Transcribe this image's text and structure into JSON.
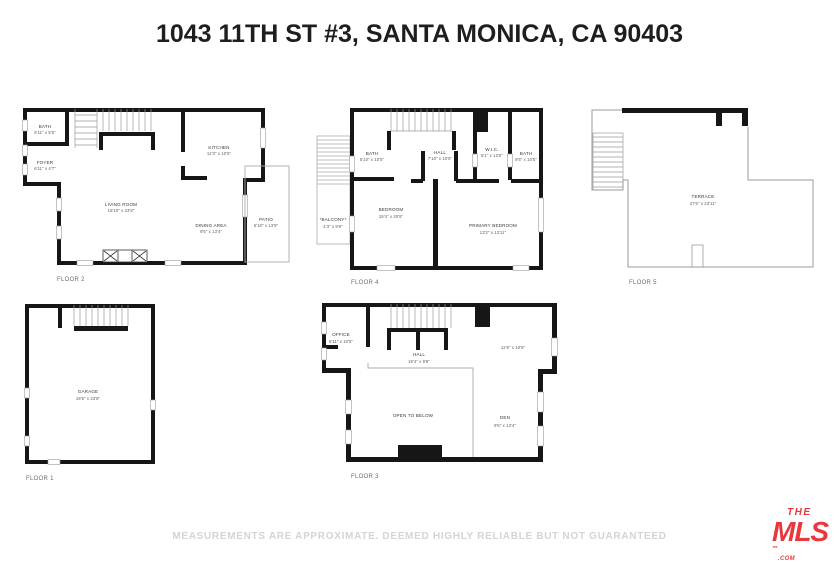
{
  "title": "1043 11TH ST #3, SANTA MONICA, CA 90403",
  "disclaimer": "MEASUREMENTS ARE APPROXIMATE. DEEMED HIGHLY RELIABLE BUT NOT GUARANTEED",
  "logo": {
    "the": "THE",
    "mls": "MLS",
    "tm": "™",
    "com": ".COM",
    "color": "#e8383d"
  },
  "colors": {
    "wall": "#161616",
    "thin_line": "#9b9b9b",
    "label": "#3a3a3a",
    "muted_text": "#d4d4d4"
  },
  "floors": {
    "f2": {
      "label": "FLOOR 2",
      "rooms": {
        "bath": {
          "name": "BATH",
          "dims": "6'11\" x 5'5\""
        },
        "foyer": {
          "name": "FOYER",
          "dims": "6'11\" x 4'7\""
        },
        "kitchen": {
          "name": "KITCHEN",
          "dims": "12'3\" x 10'5\""
        },
        "living": {
          "name": "LIVING ROOM",
          "dims": "18'10\" x 23'8\""
        },
        "dining": {
          "name": "DINING AREA",
          "dims": "9'5\" x 13'4\""
        },
        "patio": {
          "name": "PATIO",
          "dims": "5'10\" x 13'9\""
        }
      }
    },
    "f4": {
      "label": "FLOOR 4",
      "rooms": {
        "balcony": {
          "name": "*BALCONY*",
          "dims": "4'3\" x 9'8\""
        },
        "bath1": {
          "name": "BATH",
          "dims": "5'10\" x 10'5\""
        },
        "hall": {
          "name": "HALL",
          "dims": "7'10\" x 10'5\""
        },
        "wic": {
          "name": "W.I.C.",
          "dims": "5'1\" x 13'5\""
        },
        "bath2": {
          "name": "BATH",
          "dims": "9'8\" x 10'5\""
        },
        "bedroom": {
          "name": "BEDROOM",
          "dims": "15'4\" x 20'5\""
        },
        "primary": {
          "name": "PRIMARY BEDROOM",
          "dims": "13'2\" x 12'11\""
        }
      }
    },
    "f5": {
      "label": "FLOOR 5",
      "rooms": {
        "terrace": {
          "name": "TERRACE",
          "dims": "27'6\" x 23'11\""
        }
      }
    },
    "f1": {
      "label": "FLOOR 1",
      "rooms": {
        "garage": {
          "name": "GARAGE",
          "dims": "19'5\" x 23'8\""
        }
      }
    },
    "f3": {
      "label": "FLOOR 3",
      "rooms": {
        "office": {
          "name": "OFFICE",
          "dims": "6'11\" x 10'5\""
        },
        "hall": {
          "name": "HALL",
          "dims": "19'4\" x 9'8\""
        },
        "loft": {
          "dims": "12'6\" x 10'5\""
        },
        "open": {
          "name": "OPEN TO BELOW"
        },
        "den": {
          "name": "DEN",
          "dims": "9'5\" x 13'4\""
        }
      }
    }
  }
}
